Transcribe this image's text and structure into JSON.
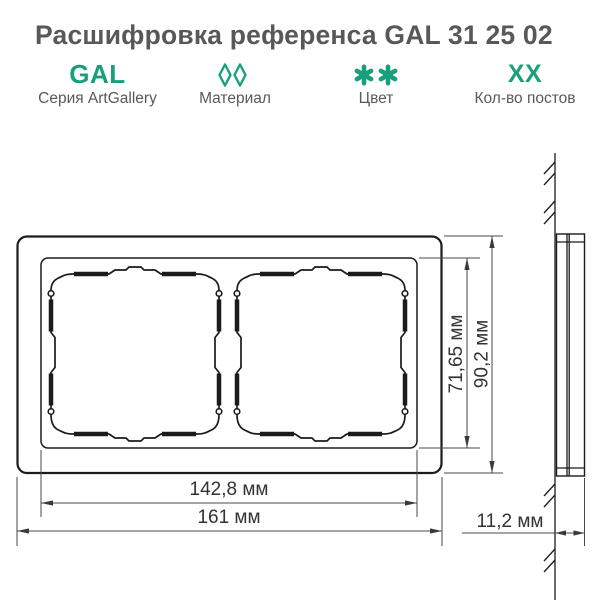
{
  "title": "Расшифровка референса GAL 31 25 02",
  "legend": {
    "items": [
      {
        "icon": "gal-code-text",
        "code": "GAL",
        "label": "Серия ArtGallery"
      },
      {
        "icon": "diamonds-icon",
        "code": "",
        "label": "Материал"
      },
      {
        "icon": "asterisks-icon",
        "code": "",
        "label": "Цвет"
      },
      {
        "icon": "xx-code-text",
        "code": "XX",
        "label": "Кол-во постов"
      }
    ]
  },
  "drawing": {
    "type": "technical drawing of 2-post ArtGallery wall frame, front view and side view",
    "dimensions": {
      "inner_height": "71,65 мм",
      "outer_height": "90,2 мм",
      "inner_width": "142,8 мм",
      "outer_width": "161 мм",
      "depth": "11,2 мм"
    }
  },
  "colors": {
    "accent_green": "#17A07A",
    "title_gray": "#57585A",
    "label_gray": "#58595B",
    "line_black": "#1B1B1B",
    "dim_gray": "#3A3A3A",
    "background": "#FFFFFF"
  }
}
